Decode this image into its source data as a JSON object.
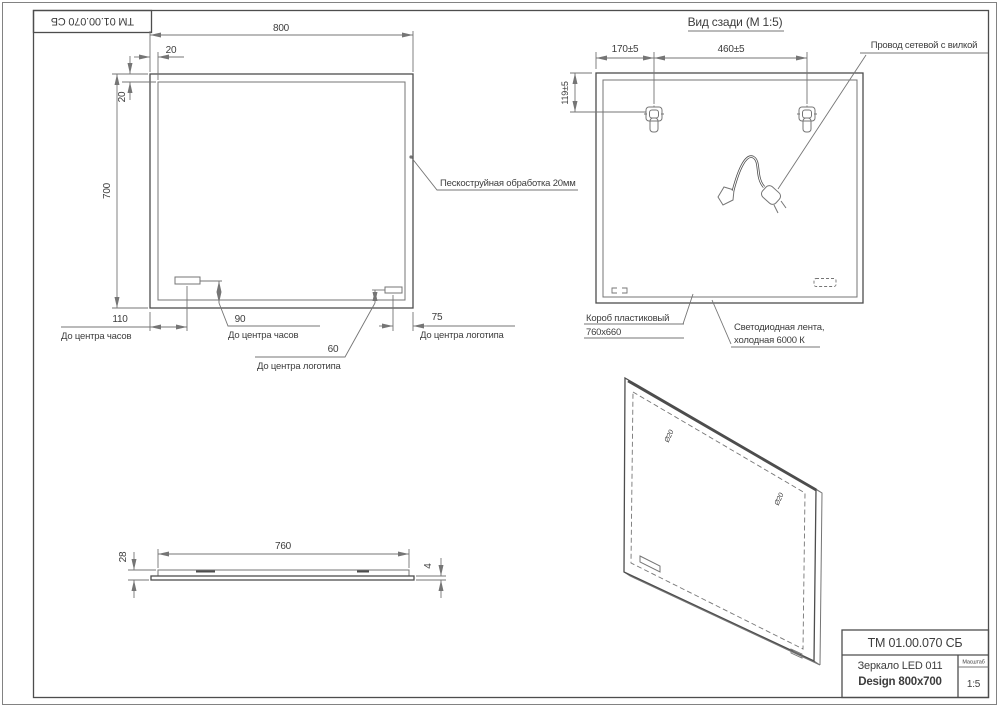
{
  "colors": {
    "bg": "#ffffff",
    "line": "#757575",
    "outline": "#4d4d4d",
    "text": "#3d3d3d"
  },
  "designation": {
    "code": "ТМ 01.00.070 СБ"
  },
  "front_view": {
    "dim_width": "800",
    "dim_height": "700",
    "dim_border_top": "20",
    "dim_border_side": "20",
    "dim_clock_from_left": "110",
    "label_clock_from_left": "До центра часов",
    "dim_clock_from_bottom": "90",
    "label_clock_from_bottom": "До центра часов",
    "dim_logo_from_right": "75",
    "label_logo_from_right": "До центра логотипа",
    "dim_logo_from_bottom": "60",
    "label_logo_from_bottom": "До центра логотипа",
    "callout_sandblast": "Пескоструйная обработка 20мм"
  },
  "back_view": {
    "title": "Вид сзади (М 1:5)",
    "dim_hanger_left": "170±5",
    "dim_hanger_span": "460±5",
    "dim_hanger_top": "119±5",
    "callout_cable": "Провод сетевой с вилкой",
    "callout_box_line1": "Короб пластиковый",
    "callout_box_line2": "760х660",
    "callout_led_line1": "Светодиодная лента,",
    "callout_led_line2": "холодная 6000 К"
  },
  "side_view": {
    "dim_length": "760",
    "dim_height": "28",
    "dim_glass": "4"
  },
  "iso_view": {
    "mark_left": "Ø20",
    "mark_right": "Ø20"
  },
  "title_block": {
    "code": "ТМ 01.00.070 СБ",
    "product_line1": "Зеркало LED 011",
    "product_line2": "Design 800x700",
    "scale_label": "Масштаб",
    "scale_value": "1:5"
  }
}
